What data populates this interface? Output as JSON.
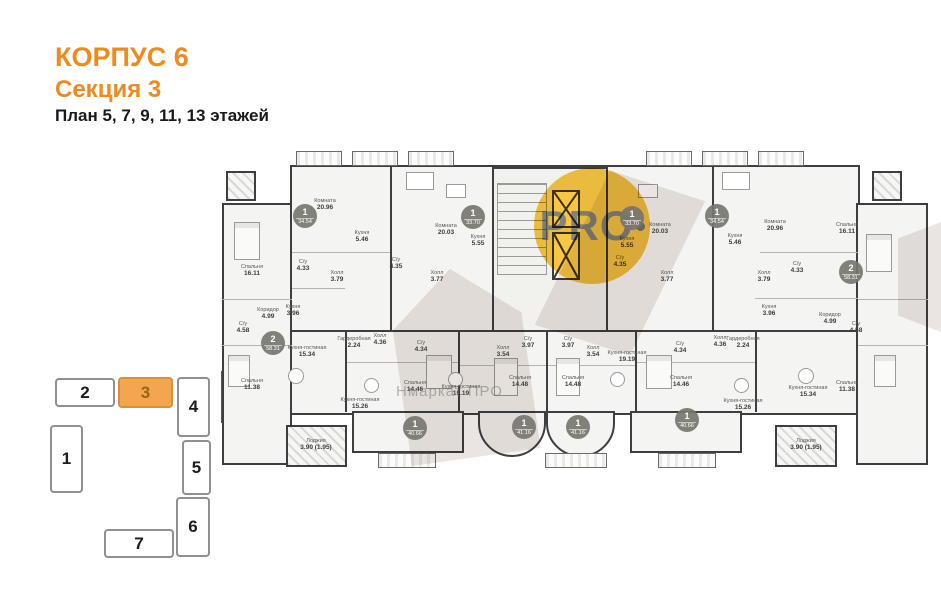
{
  "title": {
    "building": "КОРПУС 6",
    "section": "Секция 3",
    "floors": "План 5, 7, 9, 11, 13 этажей"
  },
  "watermark": {
    "logo": "PRO",
    "text": "Нмаркат ПРО"
  },
  "colors": {
    "accent": "#EE8A1E",
    "keyplan_active_fill": "#F3A64F",
    "keyplan_active_text": "#9a6316",
    "watermark_yellow": "#F7C642",
    "wall": "#3E3E40",
    "badge": "#767670",
    "room_fill": "#F4F4F2"
  },
  "keyplan": {
    "highlighted": "3",
    "blocks": [
      {
        "label": "2",
        "x": 55,
        "y": 378,
        "w": 60,
        "h": 29,
        "active": false
      },
      {
        "label": "3",
        "x": 118,
        "y": 377,
        "w": 55,
        "h": 31,
        "active": true
      },
      {
        "label": "4",
        "x": 177,
        "y": 377,
        "w": 33,
        "h": 60,
        "active": false
      },
      {
        "label": "1",
        "x": 50,
        "y": 425,
        "w": 33,
        "h": 68,
        "active": false
      },
      {
        "label": "5",
        "x": 182,
        "y": 440,
        "w": 29,
        "h": 55,
        "active": false
      },
      {
        "label": "6",
        "x": 176,
        "y": 497,
        "w": 34,
        "h": 60,
        "active": false
      },
      {
        "label": "7",
        "x": 104,
        "y": 529,
        "w": 70,
        "h": 29,
        "active": false
      }
    ]
  },
  "plan": {
    "badges": [
      {
        "type": "1",
        "area": "34.54",
        "x": 305,
        "y": 216
      },
      {
        "type": "1",
        "area": "33.70",
        "x": 473,
        "y": 217
      },
      {
        "type": "1",
        "area": "33.70",
        "x": 632,
        "y": 218
      },
      {
        "type": "1",
        "area": "34.54",
        "x": 717,
        "y": 216
      },
      {
        "type": "2",
        "area": "58.31",
        "x": 273,
        "y": 343
      },
      {
        "type": "2",
        "area": "58.31",
        "x": 851,
        "y": 272
      },
      {
        "type": "1",
        "area": "40.66",
        "x": 415,
        "y": 428
      },
      {
        "type": "1",
        "area": "41.16",
        "x": 524,
        "y": 427
      },
      {
        "type": "1",
        "area": "41.16",
        "x": 578,
        "y": 427
      },
      {
        "type": "1",
        "area": "40.66",
        "x": 687,
        "y": 420
      }
    ],
    "rooms": [
      {
        "name": "Комната",
        "area": "20.96",
        "x": 325,
        "y": 205
      },
      {
        "name": "Кухня",
        "area": "5.46",
        "x": 362,
        "y": 237
      },
      {
        "name": "С/у",
        "area": "4.33",
        "x": 303,
        "y": 266
      },
      {
        "name": "Холл",
        "area": "3.79",
        "x": 337,
        "y": 277
      },
      {
        "name": "Комната",
        "area": "20.03",
        "x": 446,
        "y": 230
      },
      {
        "name": "Кухня",
        "area": "5.55",
        "x": 478,
        "y": 241
      },
      {
        "name": "Холл",
        "area": "3.77",
        "x": 437,
        "y": 277
      },
      {
        "name": "С/у",
        "area": "4.35",
        "x": 396,
        "y": 264
      },
      {
        "name": "Комната",
        "area": "20.03",
        "x": 660,
        "y": 229
      },
      {
        "name": "Кухня",
        "area": "5.55",
        "x": 627,
        "y": 243
      },
      {
        "name": "Холл",
        "area": "3.77",
        "x": 667,
        "y": 277
      },
      {
        "name": "С/у",
        "area": "4.35",
        "x": 620,
        "y": 262
      },
      {
        "name": "Комната",
        "area": "20.96",
        "x": 775,
        "y": 226
      },
      {
        "name": "Кухня",
        "area": "5.46",
        "x": 735,
        "y": 240
      },
      {
        "name": "С/у",
        "area": "4.33",
        "x": 797,
        "y": 268
      },
      {
        "name": "Холл",
        "area": "3.79",
        "x": 764,
        "y": 277
      },
      {
        "name": "Спальня",
        "area": "16.11",
        "x": 252,
        "y": 271
      },
      {
        "name": "С/у",
        "area": "4.58",
        "x": 243,
        "y": 328
      },
      {
        "name": "Коридор",
        "area": "4.99",
        "x": 268,
        "y": 314
      },
      {
        "name": "Кухня",
        "area": "3.96",
        "x": 293,
        "y": 311
      },
      {
        "name": "Кухня-гостиная",
        "area": "15.34",
        "x": 307,
        "y": 352
      },
      {
        "name": "Спальня",
        "area": "11.38",
        "x": 252,
        "y": 385
      },
      {
        "name": "Лоджия",
        "area": "3.90 (1.95)",
        "x": 316,
        "y": 445
      },
      {
        "name": "Спальня",
        "area": "16.11",
        "x": 847,
        "y": 229
      },
      {
        "name": "С/у",
        "area": "4.58",
        "x": 856,
        "y": 328
      },
      {
        "name": "Коридор",
        "area": "4.99",
        "x": 830,
        "y": 319
      },
      {
        "name": "Кухня",
        "area": "3.96",
        "x": 769,
        "y": 311
      },
      {
        "name": "Кухня-гостиная",
        "area": "15.34",
        "x": 808,
        "y": 392
      },
      {
        "name": "Спальня",
        "area": "11.38",
        "x": 847,
        "y": 387
      },
      {
        "name": "Лоджия",
        "area": "3.90 (1.95)",
        "x": 806,
        "y": 445
      },
      {
        "name": "Гардеробная",
        "area": "2.24",
        "x": 354,
        "y": 343
      },
      {
        "name": "Холл",
        "area": "4.36",
        "x": 380,
        "y": 340
      },
      {
        "name": "С/у",
        "area": "4.34",
        "x": 421,
        "y": 347
      },
      {
        "name": "Кухня-гостиная",
        "area": "15.26",
        "x": 360,
        "y": 404
      },
      {
        "name": "Спальня",
        "area": "14.46",
        "x": 415,
        "y": 387
      },
      {
        "name": "Холл",
        "area": "3.54",
        "x": 503,
        "y": 352
      },
      {
        "name": "С/у",
        "area": "3.97",
        "x": 528,
        "y": 343
      },
      {
        "name": "Спальня",
        "area": "14.48",
        "x": 520,
        "y": 382
      },
      {
        "name": "Кухня-гостиная",
        "area": "19.19",
        "x": 461,
        "y": 391
      },
      {
        "name": "Холл",
        "area": "3.54",
        "x": 593,
        "y": 352
      },
      {
        "name": "С/у",
        "area": "3.97",
        "x": 568,
        "y": 343
      },
      {
        "name": "Спальня",
        "area": "14.48",
        "x": 573,
        "y": 382
      },
      {
        "name": "Кухня-гостиная",
        "area": "19.19",
        "x": 627,
        "y": 357
      },
      {
        "name": "Холл",
        "area": "4.36",
        "x": 720,
        "y": 342
      },
      {
        "name": "Гардеробная",
        "area": "2.24",
        "x": 743,
        "y": 343
      },
      {
        "name": "С/у",
        "area": "4.34",
        "x": 680,
        "y": 348
      },
      {
        "name": "Кухня-гостиная",
        "area": "15.26",
        "x": 743,
        "y": 405
      },
      {
        "name": "Спальня",
        "area": "14.46",
        "x": 681,
        "y": 382
      }
    ],
    "furniture": [
      {
        "t": "bed",
        "x": 234,
        "y": 222,
        "w": 26,
        "h": 38
      },
      {
        "t": "bed",
        "x": 866,
        "y": 234,
        "w": 26,
        "h": 38
      },
      {
        "t": "bed",
        "x": 228,
        "y": 355,
        "w": 22,
        "h": 32
      },
      {
        "t": "bed",
        "x": 874,
        "y": 355,
        "w": 22,
        "h": 32
      },
      {
        "t": "bed",
        "x": 426,
        "y": 355,
        "w": 26,
        "h": 34
      },
      {
        "t": "bed",
        "x": 494,
        "y": 358,
        "w": 24,
        "h": 38
      },
      {
        "t": "bed",
        "x": 556,
        "y": 358,
        "w": 24,
        "h": 38
      },
      {
        "t": "bed",
        "x": 646,
        "y": 355,
        "w": 26,
        "h": 34
      },
      {
        "t": "table",
        "x": 406,
        "y": 172,
        "w": 28,
        "h": 18
      },
      {
        "t": "table",
        "x": 722,
        "y": 172,
        "w": 28,
        "h": 18
      },
      {
        "t": "table",
        "x": 446,
        "y": 184,
        "w": 20,
        "h": 14
      },
      {
        "t": "table",
        "x": 638,
        "y": 184,
        "w": 20,
        "h": 14
      },
      {
        "t": "rtable",
        "x": 288,
        "y": 368,
        "w": 16,
        "h": 16
      },
      {
        "t": "rtable",
        "x": 798,
        "y": 368,
        "w": 16,
        "h": 16
      },
      {
        "t": "rtable",
        "x": 364,
        "y": 378,
        "w": 15,
        "h": 15
      },
      {
        "t": "rtable",
        "x": 448,
        "y": 372,
        "w": 15,
        "h": 15
      },
      {
        "t": "rtable",
        "x": 610,
        "y": 372,
        "w": 15,
        "h": 15
      },
      {
        "t": "rtable",
        "x": 734,
        "y": 378,
        "w": 15,
        "h": 15
      }
    ]
  }
}
